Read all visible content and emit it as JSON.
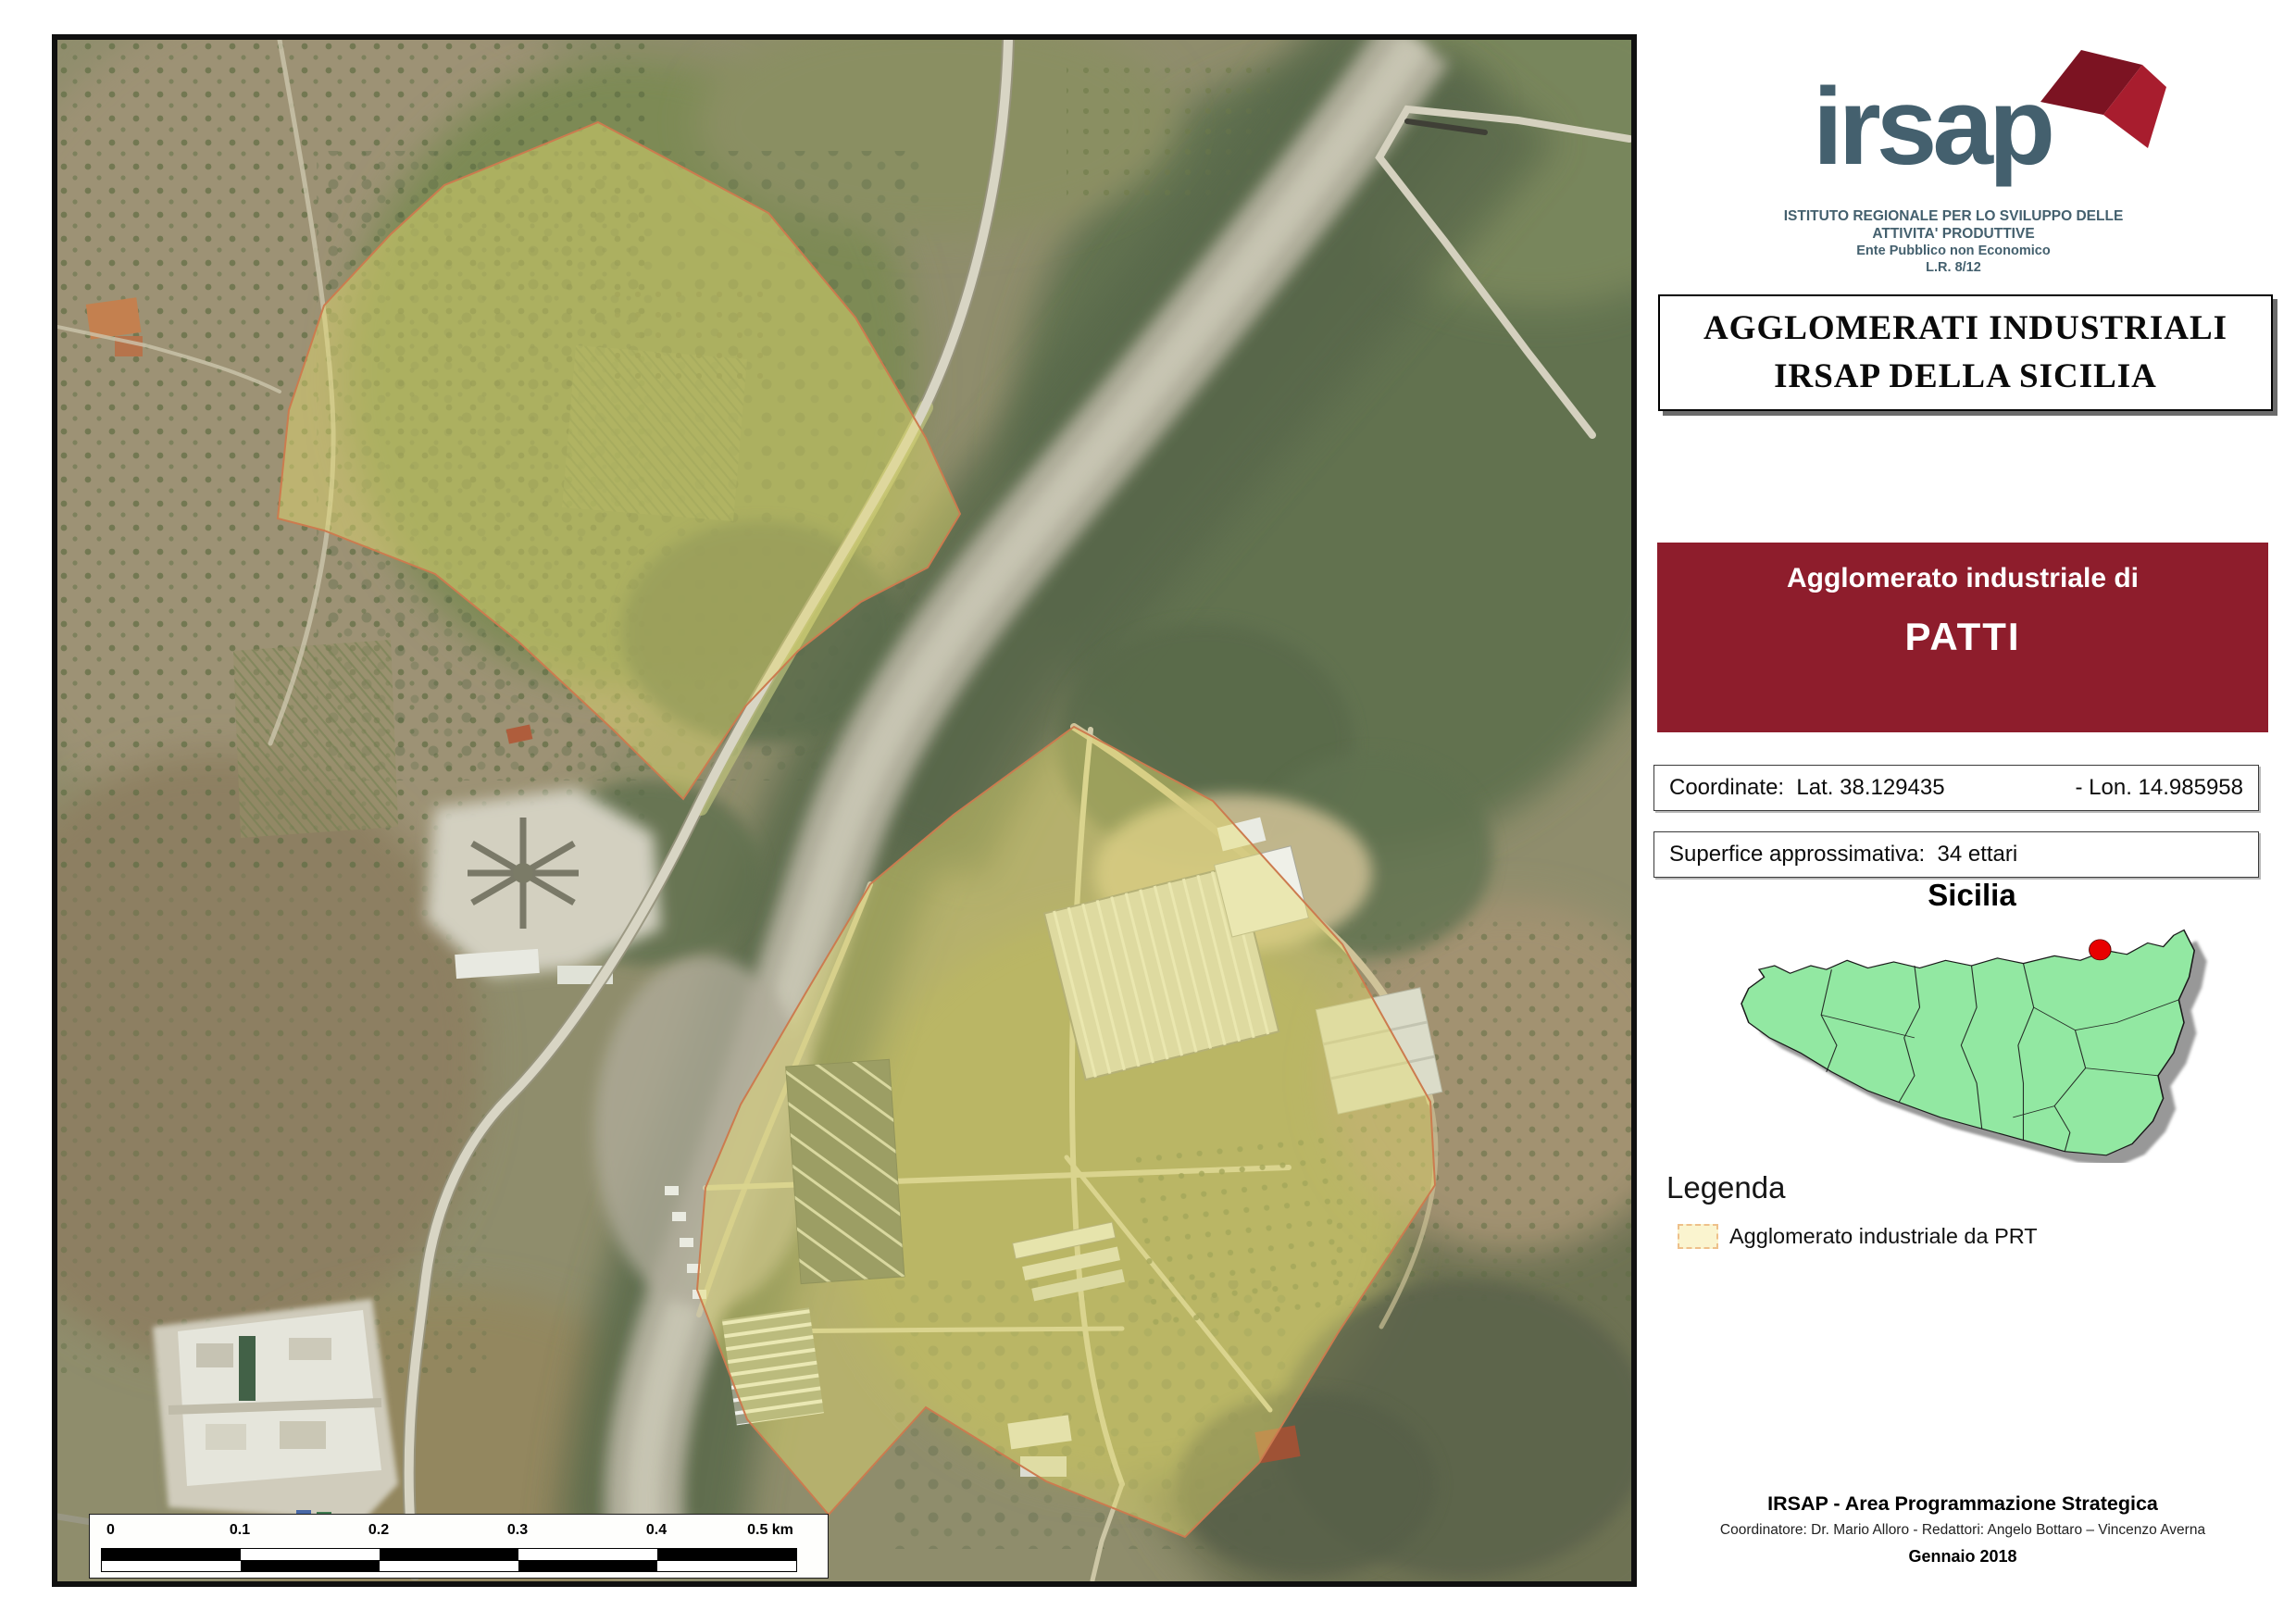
{
  "logo": {
    "text": "irsap",
    "institute_line1": "ISTITUTO REGIONALE PER LO SVILUPPO DELLE",
    "institute_line2": "ATTIVITA' PRODUTTIVE",
    "institute_line3": "Ente Pubblico non Economico",
    "institute_line4": "L.R. 8/12"
  },
  "title_box": {
    "line1": "AGGLOMERATI INDUSTRIALI",
    "line2": "IRSAP DELLA SICILIA"
  },
  "agglomerato_box": {
    "label": "Agglomerato industriale di",
    "name": "PATTI"
  },
  "info": {
    "coordinate_label": "Coordinate:",
    "lat": "Lat. 38.129435",
    "lon": "- Lon. 14.985958",
    "superficie_label": "Superfice approssimativa:",
    "superficie_value": "34 ettari"
  },
  "inset": {
    "title": "Sicilia",
    "marker": "patti-location-red-dot"
  },
  "legend": {
    "title": "Legenda",
    "item1": "Agglomerato industriale da PRT"
  },
  "footer": {
    "line1": "IRSAP - Area Programmazione Strategica",
    "line2": "Coordinatore: Dr. Mario Alloro  -  Redattori: Angelo Bottaro – Vincenzo Averna",
    "line3": "Gennaio 2018"
  },
  "scalebar": {
    "labels": [
      "0",
      "0.1",
      "0.2",
      "0.3",
      "0.4",
      "0.5 km"
    ],
    "unit": "km"
  },
  "colors": {
    "maroon": "#8e1d2c",
    "logo-slate": "#44606e",
    "flag-red": "#a81d2e",
    "flag-red-dark": "#7c1322",
    "sicily-green": "#92e8a2",
    "marker-red": "#e80000",
    "legend-swatch-bg": "#faf4cf",
    "legend-swatch-border": "#eec08a",
    "overlay-yellow": "rgba(233,223,110,0.45)",
    "overlay-stroke": "#cf7a4e"
  }
}
